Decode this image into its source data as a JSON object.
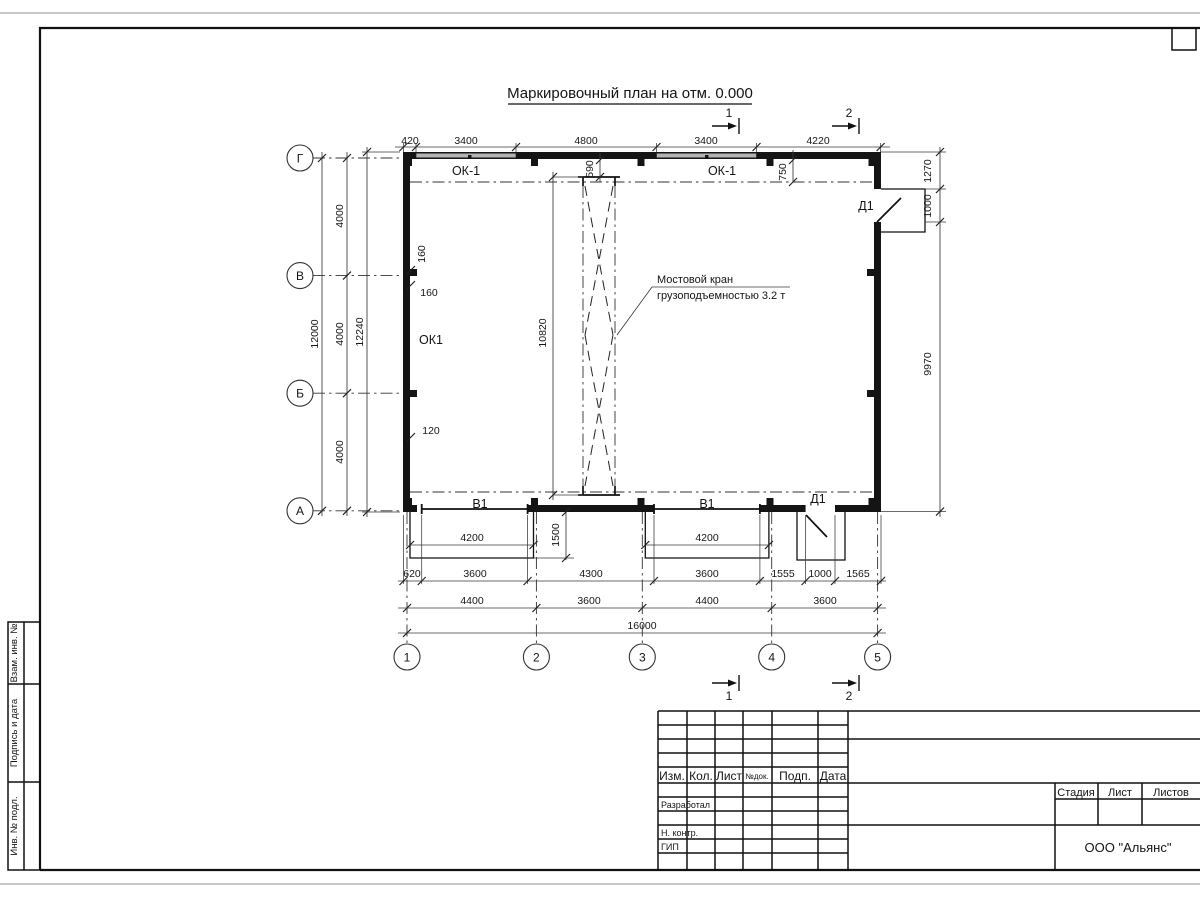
{
  "title": "Маркировочный план на отм. 0.000",
  "plan": {
    "row_axes": [
      "Г",
      "В",
      "Б",
      "А"
    ],
    "col_axes": [
      "1",
      "2",
      "3",
      "4",
      "5"
    ],
    "labels": {
      "window_top_left": "ОК-1",
      "window_top_right": "ОК-1",
      "window_left": "ОК1",
      "gate_left": "В1",
      "gate_right": "В1",
      "door_top": "Д1",
      "door_bottom": "Д1"
    },
    "crane_note": {
      "line1": "Мостовой кран",
      "line2": "грузоподъемностью 3.2 т"
    },
    "section_marks": {
      "m1": "1",
      "m2": "2"
    },
    "dims": [
      {
        "t": "420",
        "x": 410,
        "y": 144
      },
      {
        "t": "3400",
        "x": 466,
        "y": 144
      },
      {
        "t": "4800",
        "x": 586,
        "y": 144
      },
      {
        "t": "3400",
        "x": 706,
        "y": 144
      },
      {
        "t": "4220",
        "x": 818,
        "y": 144
      },
      {
        "t": "12000",
        "x": 318,
        "y": 334,
        "r": 1
      },
      {
        "t": "4000",
        "x": 343,
        "y": 216,
        "r": 1
      },
      {
        "t": "4000",
        "x": 343,
        "y": 334,
        "r": 1
      },
      {
        "t": "4000",
        "x": 343,
        "y": 452,
        "r": 1
      },
      {
        "t": "12240",
        "x": 363,
        "y": 332,
        "r": 1
      },
      {
        "t": "1270",
        "x": 931,
        "y": 171,
        "r": 1
      },
      {
        "t": "1000",
        "x": 931,
        "y": 206,
        "r": 1
      },
      {
        "t": "9970",
        "x": 931,
        "y": 364,
        "r": 1
      },
      {
        "t": "590",
        "x": 593,
        "y": 169,
        "r": 1
      },
      {
        "t": "750",
        "x": 786,
        "y": 172,
        "r": 1
      },
      {
        "t": "10820",
        "x": 546,
        "y": 333,
        "r": 1
      },
      {
        "t": "1500",
        "x": 559,
        "y": 535,
        "r": 1
      },
      {
        "t": "160",
        "x": 425,
        "y": 254,
        "r": 1
      },
      {
        "t": "160",
        "x": 429,
        "y": 296
      },
      {
        "t": "120",
        "x": 431,
        "y": 434
      },
      {
        "t": "4200",
        "x": 472,
        "y": 541
      },
      {
        "t": "4200",
        "x": 707,
        "y": 541
      },
      {
        "t": "620",
        "x": 412,
        "y": 577
      },
      {
        "t": "3600",
        "x": 475,
        "y": 577
      },
      {
        "t": "4300",
        "x": 591,
        "y": 577
      },
      {
        "t": "3600",
        "x": 707,
        "y": 577
      },
      {
        "t": "1555",
        "x": 783,
        "y": 577
      },
      {
        "t": "1000",
        "x": 820,
        "y": 577
      },
      {
        "t": "1565",
        "x": 858,
        "y": 577
      },
      {
        "t": "4400",
        "x": 472,
        "y": 604
      },
      {
        "t": "3600",
        "x": 589,
        "y": 604
      },
      {
        "t": "4400",
        "x": 707,
        "y": 604
      },
      {
        "t": "3600",
        "x": 825,
        "y": 604
      },
      {
        "t": "16000",
        "x": 642,
        "y": 629
      }
    ]
  },
  "stamp_strip": {
    "box1": "Взам. инв. №",
    "box2": "Подпись и дата",
    "box3": "Инв. № подл."
  },
  "title_block": {
    "revision_header": [
      "Изм.",
      "Кол.",
      "Лист",
      "№док.",
      "Подп.",
      "Дата"
    ],
    "signature_rows": [
      "Разработал",
      "Н. контр.",
      "ГИП"
    ],
    "sheet_header": [
      "Стадия",
      "Лист",
      "Листов"
    ],
    "company": "ООО \"Альянс\""
  }
}
